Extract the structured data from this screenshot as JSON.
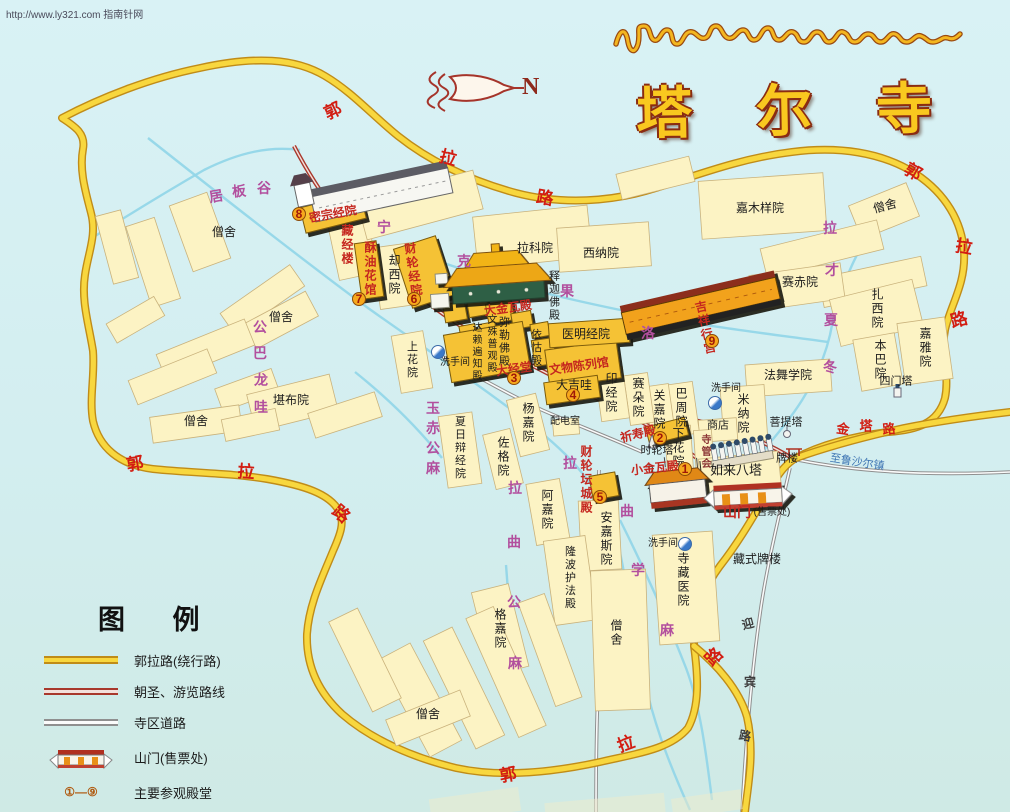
{
  "watermark": "http://www.ly321.com 指南针网",
  "title": {
    "tibetan": "སྐུ་འབུམ་བྱམས་པ་གླིང་།",
    "chinese": "塔尔寺"
  },
  "compass": {
    "label": "N"
  },
  "legend": {
    "title": "图 例",
    "items": [
      {
        "label": "郭拉路(绕行路)",
        "type": "ring-road"
      },
      {
        "label": "朝圣、游览路线",
        "type": "pilgrim-route"
      },
      {
        "label": "寺区道路",
        "type": "temple-road"
      },
      {
        "label": "山门(售票处)",
        "type": "gate"
      },
      {
        "label": "主要参观殿堂",
        "type": "main-halls",
        "range": "①—⑨"
      },
      {
        "label": "洗手间",
        "type": "toilet"
      }
    ]
  },
  "map": {
    "labels": [
      {
        "t": "僧舍",
        "x": 224,
        "y": 232,
        "c": "k"
      },
      {
        "t": "僧舍",
        "x": 281,
        "y": 317,
        "c": "k"
      },
      {
        "t": "僧舍",
        "x": 196,
        "y": 421,
        "c": "k"
      },
      {
        "t": "僧舍",
        "x": 885,
        "y": 206,
        "c": "k",
        "r": -15
      },
      {
        "t": "僧舍",
        "x": 428,
        "y": 714,
        "c": "k"
      },
      {
        "t": "僧舍",
        "x": 616,
        "y": 633,
        "c": "k",
        "v": 1
      },
      {
        "t": "拉科院",
        "x": 535,
        "y": 248,
        "c": "k"
      },
      {
        "t": "西纳院",
        "x": 601,
        "y": 253,
        "c": "k"
      },
      {
        "t": "嘉木样院",
        "x": 760,
        "y": 208,
        "c": "k"
      },
      {
        "t": "赛赤院",
        "x": 800,
        "y": 282,
        "c": "k"
      },
      {
        "t": "扎西院",
        "x": 877,
        "y": 309,
        "c": "k",
        "v": 1
      },
      {
        "t": "嘉雅院",
        "x": 925,
        "y": 348,
        "c": "k",
        "v": 1
      },
      {
        "t": "本巴院",
        "x": 880,
        "y": 360,
        "c": "k",
        "v": 1
      },
      {
        "t": "四门塔",
        "x": 896,
        "y": 382,
        "c": "k",
        "s": 11
      },
      {
        "t": "法舞学院",
        "x": 788,
        "y": 375,
        "c": "k"
      },
      {
        "t": "米纳院",
        "x": 743,
        "y": 414,
        "c": "k",
        "v": 1
      },
      {
        "t": "菩提塔",
        "x": 786,
        "y": 423,
        "c": "k",
        "s": 11
      },
      {
        "t": "商店",
        "x": 718,
        "y": 426,
        "c": "k",
        "s": 11
      },
      {
        "t": "巴周院",
        "x": 681,
        "y": 408,
        "c": "k",
        "v": 1
      },
      {
        "t": "关嘉院",
        "x": 659,
        "y": 410,
        "c": "k",
        "v": 1
      },
      {
        "t": "赛朵院",
        "x": 638,
        "y": 398,
        "c": "k",
        "v": 1
      },
      {
        "t": "印经院",
        "x": 611,
        "y": 393,
        "c": "k",
        "v": 1
      },
      {
        "t": "下花院",
        "x": 678,
        "y": 448,
        "c": "k",
        "v": 1
      },
      {
        "t": "如来八塔",
        "x": 736,
        "y": 470,
        "c": "k",
        "s": 13
      },
      {
        "t": "牌楼",
        "x": 787,
        "y": 459,
        "c": "k",
        "s": 11
      },
      {
        "t": "藏式牌楼",
        "x": 757,
        "y": 559,
        "c": "k"
      },
      {
        "t": "堪布院",
        "x": 291,
        "y": 400,
        "c": "k"
      },
      {
        "t": "却西院",
        "x": 394,
        "y": 275,
        "c": "k",
        "v": 1
      },
      {
        "t": "医明经院",
        "x": 586,
        "y": 334,
        "c": "k"
      },
      {
        "t": "释迦佛殿",
        "x": 553,
        "y": 296,
        "c": "k",
        "v": 1,
        "s": 11
      },
      {
        "t": "依怙殿",
        "x": 535,
        "y": 348,
        "c": "k",
        "v": 1,
        "s": 11
      },
      {
        "t": "弥勒佛殿",
        "x": 503,
        "y": 342,
        "c": "k",
        "v": 1,
        "s": 11
      },
      {
        "t": "文殊普观殿",
        "x": 490,
        "y": 344,
        "c": "k",
        "v": 1,
        "s": 10
      },
      {
        "t": "达赖遍知殿",
        "x": 475,
        "y": 352,
        "c": "k",
        "v": 1,
        "s": 10
      },
      {
        "t": "大吉哇",
        "x": 574,
        "y": 385,
        "c": "k"
      },
      {
        "t": "配电室",
        "x": 565,
        "y": 422,
        "c": "k",
        "s": 10
      },
      {
        "t": "时轮塔",
        "x": 657,
        "y": 451,
        "c": "k",
        "s": 11
      },
      {
        "t": "上花院",
        "x": 411,
        "y": 360,
        "c": "k",
        "v": 1,
        "s": 11
      },
      {
        "t": "夏日辩经院",
        "x": 459,
        "y": 448,
        "c": "k",
        "v": 1,
        "s": 11
      },
      {
        "t": "杨嘉院",
        "x": 528,
        "y": 423,
        "c": "k",
        "v": 1
      },
      {
        "t": "佐格院",
        "x": 503,
        "y": 457,
        "c": "k",
        "v": 1
      },
      {
        "t": "阿嘉院",
        "x": 547,
        "y": 510,
        "c": "k",
        "v": 1
      },
      {
        "t": "安嘉斯院",
        "x": 606,
        "y": 539,
        "c": "k",
        "v": 1
      },
      {
        "t": "隆波护法殿",
        "x": 569,
        "y": 578,
        "c": "k",
        "v": 1,
        "s": 11
      },
      {
        "t": "格嘉院",
        "x": 500,
        "y": 629,
        "c": "k",
        "v": 1
      },
      {
        "t": "寺藏医院",
        "x": 683,
        "y": 580,
        "c": "k",
        "v": 1
      },
      {
        "t": "洗手间",
        "x": 455,
        "y": 363,
        "c": "k",
        "s": 10
      },
      {
        "t": "洗手间",
        "x": 726,
        "y": 389,
        "c": "k",
        "s": 10
      },
      {
        "t": "洗手间",
        "x": 663,
        "y": 544,
        "c": "k",
        "s": 10
      },
      {
        "t": "山门",
        "x": 737,
        "y": 512,
        "c": "h",
        "s": 14
      },
      {
        "t": "(售票处)",
        "x": 772,
        "y": 513,
        "c": "k",
        "s": 10
      },
      {
        "t": "大金瓦殿",
        "x": 508,
        "y": 308,
        "c": "h",
        "r": -8
      },
      {
        "t": "大经堂",
        "x": 514,
        "y": 369,
        "c": "h",
        "r": -8
      },
      {
        "t": "文物陈列馆",
        "x": 579,
        "y": 366,
        "c": "h",
        "r": -8
      },
      {
        "t": "祈寿殿",
        "x": 638,
        "y": 434,
        "c": "h",
        "r": -14
      },
      {
        "t": "小金瓦殿",
        "x": 655,
        "y": 468,
        "c": "h",
        "r": -6
      },
      {
        "t": "财轮坛城殿",
        "x": 586,
        "y": 480,
        "c": "h",
        "v": 1,
        "s": 12
      },
      {
        "t": "吉祥行宫",
        "x": 705,
        "y": 328,
        "c": "h",
        "v": 1,
        "r": -12,
        "s": 12
      },
      {
        "t": "密宗经院",
        "x": 333,
        "y": 214,
        "c": "h",
        "r": -10
      },
      {
        "t": "酥油花馆",
        "x": 370,
        "y": 269,
        "c": "h",
        "v": 1,
        "s": 12
      },
      {
        "t": "财轮经院",
        "x": 413,
        "y": 270,
        "c": "h",
        "v": 1,
        "s": 12,
        "r": -8
      },
      {
        "t": "藏经楼",
        "x": 347,
        "y": 245,
        "c": "h",
        "v": 1,
        "s": 12
      },
      {
        "t": "郭",
        "x": 333,
        "y": 111,
        "c": "rd",
        "r": -25
      },
      {
        "t": "拉",
        "x": 448,
        "y": 158,
        "c": "rd",
        "r": 15
      },
      {
        "t": "路",
        "x": 545,
        "y": 198,
        "c": "rd",
        "r": 10
      },
      {
        "t": "郭",
        "x": 913,
        "y": 172,
        "c": "rd",
        "r": 30
      },
      {
        "t": "拉",
        "x": 964,
        "y": 247,
        "c": "rd",
        "r": 10
      },
      {
        "t": "路",
        "x": 959,
        "y": 320,
        "c": "rd",
        "r": -15
      },
      {
        "t": "郭",
        "x": 135,
        "y": 464,
        "c": "rd",
        "r": -10
      },
      {
        "t": "拉",
        "x": 246,
        "y": 472,
        "c": "rd",
        "r": 5
      },
      {
        "t": "路",
        "x": 341,
        "y": 514,
        "c": "rd",
        "r": 40
      },
      {
        "t": "郭",
        "x": 508,
        "y": 775,
        "c": "rd",
        "r": -10
      },
      {
        "t": "拉",
        "x": 626,
        "y": 744,
        "c": "rd",
        "r": -20
      },
      {
        "t": "路",
        "x": 714,
        "y": 657,
        "c": "rd",
        "r": -45
      },
      {
        "t": "金",
        "x": 843,
        "y": 429,
        "c": "rd",
        "s": 13,
        "r": 8
      },
      {
        "t": "塔",
        "x": 866,
        "y": 426,
        "c": "rd",
        "s": 13
      },
      {
        "t": "路",
        "x": 889,
        "y": 429,
        "c": "rd",
        "s": 13,
        "r": -5
      },
      {
        "t": "至鲁沙尔镇",
        "x": 857,
        "y": 463,
        "c": "bl",
        "r": 9,
        "s": 11
      },
      {
        "t": "迎",
        "x": 748,
        "y": 624,
        "c": "dk",
        "r": -15
      },
      {
        "t": "宾",
        "x": 750,
        "y": 682,
        "c": "dk"
      },
      {
        "t": "路",
        "x": 745,
        "y": 736,
        "c": "dk",
        "r": 10
      },
      {
        "t": "居",
        "x": 216,
        "y": 196,
        "c": "p",
        "r": -10
      },
      {
        "t": "板",
        "x": 239,
        "y": 191,
        "c": "p",
        "r": -5
      },
      {
        "t": "谷",
        "x": 264,
        "y": 188,
        "c": "p"
      },
      {
        "t": "宁",
        "x": 384,
        "y": 227,
        "c": "p"
      },
      {
        "t": "克",
        "x": 464,
        "y": 261,
        "c": "p"
      },
      {
        "t": "果",
        "x": 567,
        "y": 291,
        "c": "p"
      },
      {
        "t": "洛",
        "x": 648,
        "y": 333,
        "c": "p"
      },
      {
        "t": "拉",
        "x": 830,
        "y": 228,
        "c": "p"
      },
      {
        "t": "才",
        "x": 832,
        "y": 270,
        "c": "p"
      },
      {
        "t": "夏",
        "x": 831,
        "y": 320,
        "c": "p"
      },
      {
        "t": "冬",
        "x": 830,
        "y": 367,
        "c": "p"
      },
      {
        "t": "公",
        "x": 260,
        "y": 327,
        "c": "p"
      },
      {
        "t": "巴",
        "x": 260,
        "y": 353,
        "c": "p"
      },
      {
        "t": "龙",
        "x": 261,
        "y": 380,
        "c": "p"
      },
      {
        "t": "哇",
        "x": 261,
        "y": 407,
        "c": "p"
      },
      {
        "t": "玉",
        "x": 433,
        "y": 408,
        "c": "p"
      },
      {
        "t": "赤",
        "x": 433,
        "y": 428,
        "c": "p"
      },
      {
        "t": "公",
        "x": 433,
        "y": 448,
        "c": "p"
      },
      {
        "t": "麻",
        "x": 433,
        "y": 468,
        "c": "p"
      },
      {
        "t": "拉",
        "x": 570,
        "y": 463,
        "c": "p"
      },
      {
        "t": "曲",
        "x": 627,
        "y": 511,
        "c": "p"
      },
      {
        "t": "拉",
        "x": 515,
        "y": 488,
        "c": "p"
      },
      {
        "t": "曲",
        "x": 514,
        "y": 542,
        "c": "p"
      },
      {
        "t": "公",
        "x": 514,
        "y": 602,
        "c": "p"
      },
      {
        "t": "麻",
        "x": 515,
        "y": 663,
        "c": "p"
      },
      {
        "t": "学",
        "x": 638,
        "y": 570,
        "c": "p"
      },
      {
        "t": "麻",
        "x": 667,
        "y": 630,
        "c": "p"
      },
      {
        "t": "寺管会",
        "x": 704,
        "y": 452,
        "c": "mr",
        "v": 1,
        "s": 10
      },
      {
        "t": "8",
        "x": 299,
        "y": 214,
        "c": "bg"
      },
      {
        "t": "7",
        "x": 359,
        "y": 299,
        "c": "bg"
      },
      {
        "t": "6",
        "x": 414,
        "y": 299,
        "c": "bg"
      },
      {
        "t": "3",
        "x": 514,
        "y": 378,
        "c": "bg"
      },
      {
        "t": "4",
        "x": 573,
        "y": 395,
        "c": "bg"
      },
      {
        "t": "2",
        "x": 660,
        "y": 438,
        "c": "bg"
      },
      {
        "t": "1",
        "x": 685,
        "y": 469,
        "c": "bg"
      },
      {
        "t": "5",
        "x": 600,
        "y": 497,
        "c": "bg"
      },
      {
        "t": "9",
        "x": 712,
        "y": 341,
        "c": "bg"
      }
    ],
    "toilets": [
      {
        "x": 437,
        "y": 351
      },
      {
        "x": 714,
        "y": 402
      },
      {
        "x": 684,
        "y": 543
      }
    ]
  }
}
